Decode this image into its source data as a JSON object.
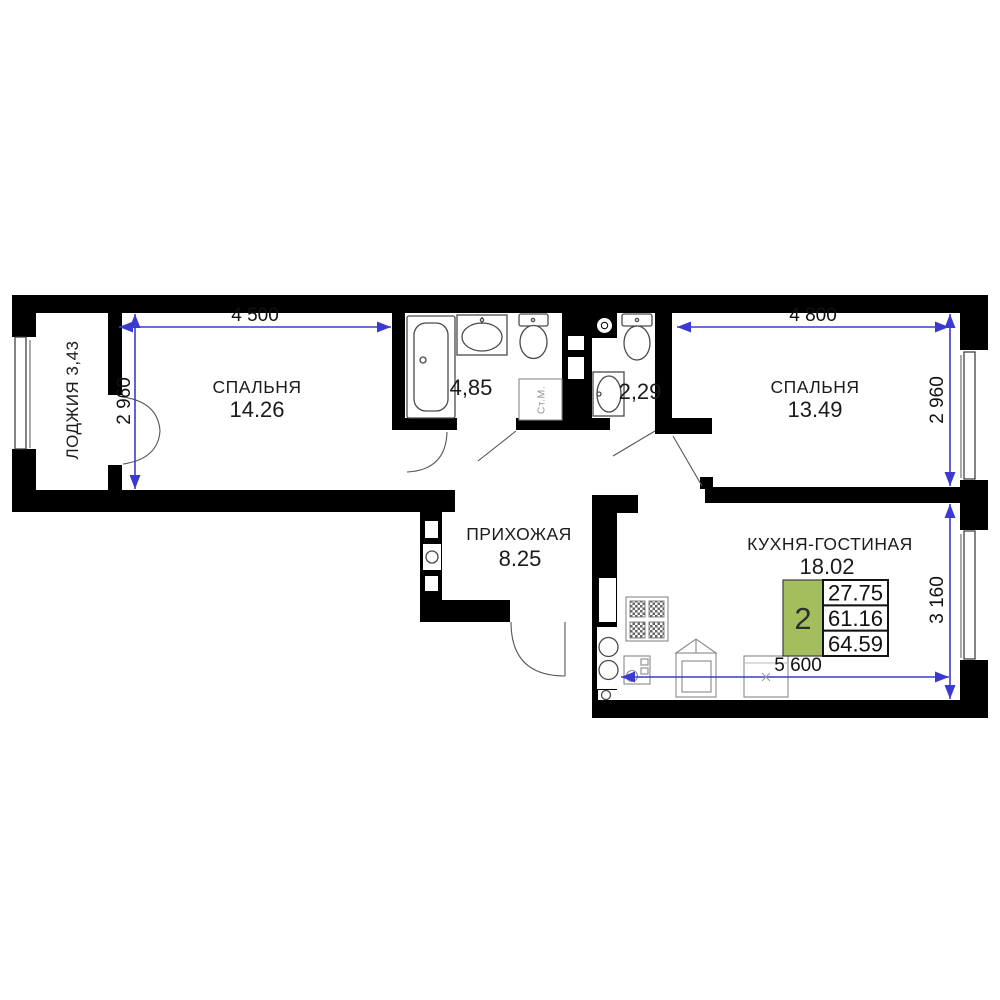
{
  "rooms": {
    "loggia": {
      "label": "ЛОДЖИЯ 3,43"
    },
    "bedroom1": {
      "label": "СПАЛЬНЯ",
      "area": "14.26"
    },
    "bathroom": {
      "area": "4,85"
    },
    "toilet": {
      "area": "2,29"
    },
    "bedroom2": {
      "label": "СПАЛЬНЯ",
      "area": "13.49"
    },
    "hallway": {
      "label": "ПРИХОЖАЯ",
      "area": "8.25"
    },
    "kitchen": {
      "label": "КУХНЯ-ГОСТИНАЯ",
      "area": "18.02"
    }
  },
  "dimensions": {
    "bedroom1_width": "4 500",
    "bedroom2_width": "4 800",
    "bedroom1_depth": "2 960",
    "bedroom2_depth": "2 960",
    "kitchen_depth": "3 160",
    "kitchen_width": "5 600"
  },
  "fixtures": {
    "washing_machine": "Ст.М."
  },
  "info_badge": {
    "room_count": "2",
    "values": [
      "27.75",
      "61.16",
      "64.59"
    ]
  },
  "colors": {
    "wall": "#000000",
    "dimension_line": "#3a3ad0",
    "badge_green": "#a4be5e"
  }
}
